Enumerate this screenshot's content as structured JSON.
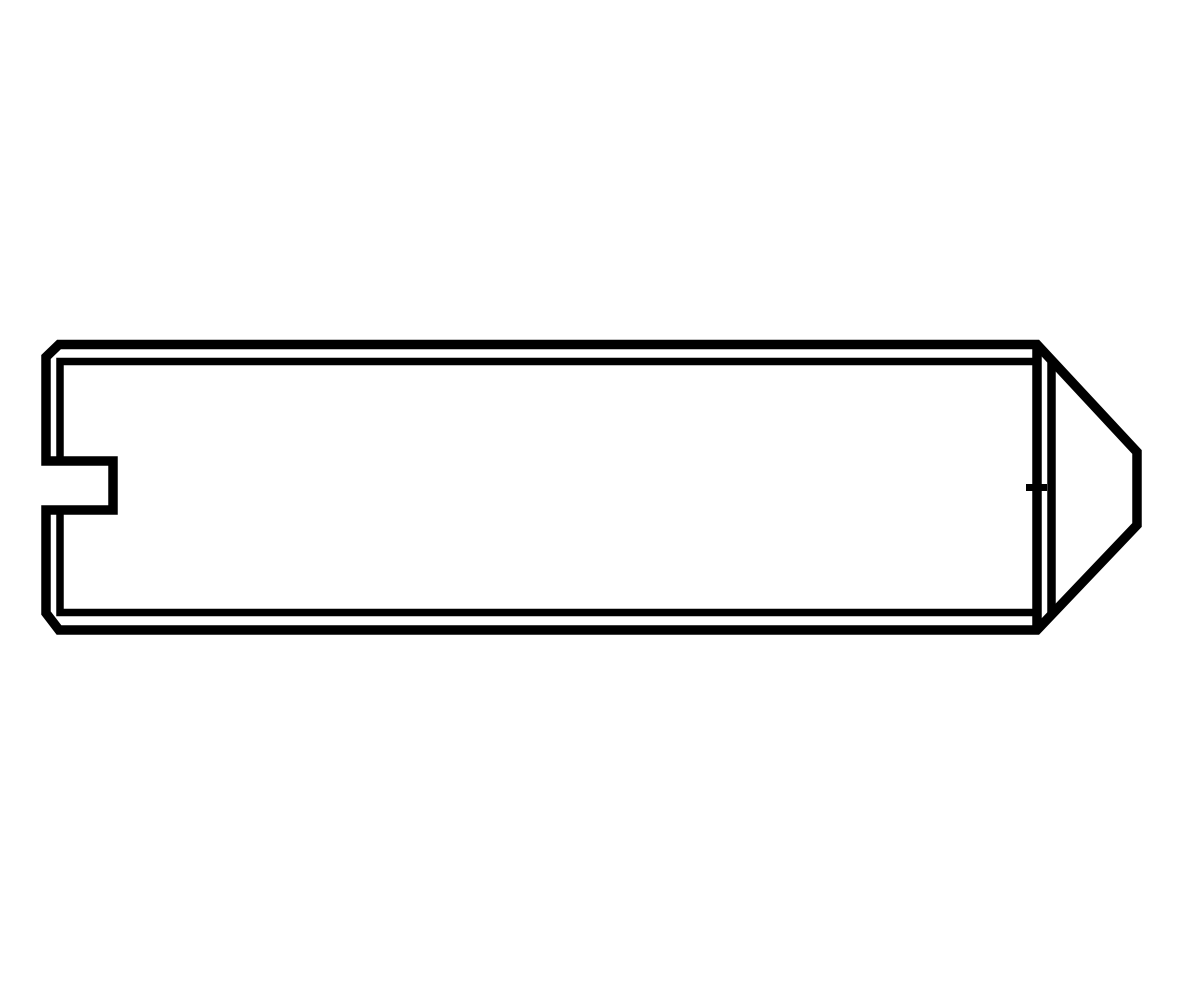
{
  "page": {
    "background": "#ffffff"
  },
  "diagram": {
    "subject": "slotted-set-screw-with-cone-point-side-view",
    "canvas": {
      "width": 1200,
      "height": 1000
    },
    "colors": {
      "stroke": "#000000",
      "fill": "#ffffff"
    },
    "shapes": [
      {
        "name": "screw-outer-contour",
        "closed": true,
        "stroke_width": 9.5,
        "points": [
          [
            59,
            344.5
          ],
          [
            1037,
            344.5
          ],
          [
            1137,
            452
          ],
          [
            1137,
            525
          ],
          [
            1037,
            630
          ],
          [
            59,
            630
          ],
          [
            46,
            613
          ],
          [
            46,
            510
          ],
          [
            113,
            510
          ],
          [
            113,
            461
          ],
          [
            46,
            461
          ],
          [
            46,
            357
          ]
        ]
      },
      {
        "name": "cone-point-base-line",
        "closed": false,
        "stroke_width": 9.5,
        "points": [
          [
            1037,
            344.5
          ],
          [
            1037,
            630
          ]
        ]
      },
      {
        "name": "cone-point-chamfer-line",
        "closed": false,
        "stroke_width": 8.5,
        "points": [
          [
            1051.5,
            361.5
          ],
          [
            1051.5,
            613
          ]
        ]
      },
      {
        "name": "top-chamfer-line",
        "closed": false,
        "stroke_width": 7.5,
        "points": [
          [
            60,
            461
          ],
          [
            60,
            361.5
          ],
          [
            1033,
            361.5
          ]
        ]
      },
      {
        "name": "bottom-chamfer-line",
        "closed": false,
        "stroke_width": 7.5,
        "points": [
          [
            60,
            510
          ],
          [
            60,
            612.5
          ],
          [
            1033,
            612.5
          ]
        ]
      },
      {
        "name": "center-tick-mark",
        "closed": false,
        "stroke_width": 7,
        "points": [
          [
            1026,
            487.5
          ],
          [
            1047,
            487.5
          ]
        ]
      }
    ]
  }
}
